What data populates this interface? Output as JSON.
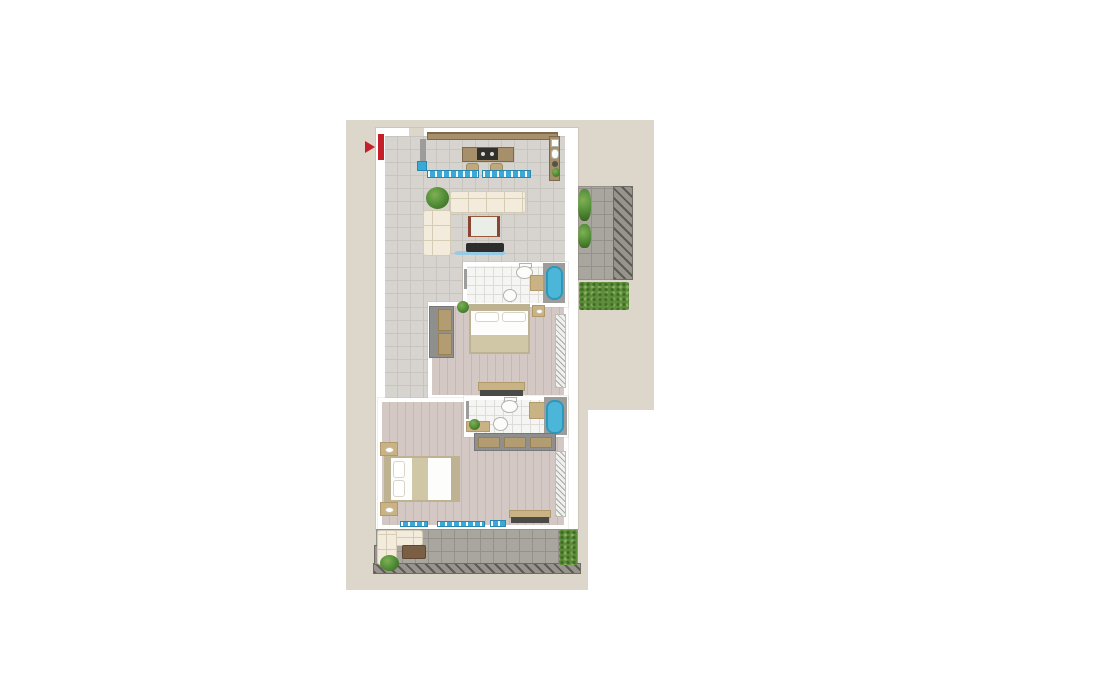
{
  "meta": {
    "type": "floor-plan",
    "description": "Top-down rendered apartment floor plan with no text labels: open living room with kitchen, two bathrooms, two bedrooms, upper-right balcony and lower terrace, red entrance door marker at upper left"
  },
  "palette": {
    "backdrop": "#ddd7cb",
    "wall": "#ffffff",
    "tile-floor": "#d7d4cf",
    "tile-line": "#c8c4be",
    "wood-floor": "#d4c8c4",
    "wood-line": "#c6b8b4",
    "bath-floor": "#f5f5f3",
    "bath-line": "#dddcd7",
    "terrace-tile": "#a9a69f",
    "terrace-line": "#94918a",
    "railing-base": "#97948d",
    "railing-dash": "#5c5a52",
    "railing-edge": "#6e6c65",
    "hedge": "#5e8d3c",
    "hedge-dot-dark": "#3f6b26",
    "hedge-dot-light": "#86b35a",
    "plant": "#4e8a34",
    "plant-light": "#7fb054",
    "plant-dark": "#39651f",
    "tub": "#4cb6d8",
    "tub-rim": "#2f98ba",
    "tub-pad": "#9c9c9a",
    "counter": "#a5906b",
    "counter-edge": "#7c6a4b",
    "stool": "#bfa87c",
    "stove": "#32302b",
    "burner": "#d8dadc",
    "sofa": "#f3ecdc",
    "sofa-edge": "#d6ccb5",
    "wardrobe": "#8f8f8d",
    "wardrobe-door": "#b39c72",
    "bed-frame": "#bdb292",
    "blanket": "#cfc7a6",
    "tan": "#c9b283",
    "fixture": "#fcfcfb",
    "fixture-edge": "#b3b3ae",
    "radiator": "#f0f0ee",
    "radiator-line": "#a8a8a4",
    "glass": "#3ba9d8",
    "glass-shelf": "#8fc9e9",
    "door-red": "#c5202a",
    "tv-dark": "#2d2d2d",
    "table-brown": "#7b5f45",
    "desk-top": "#e9eee6",
    "desk-side": "#8a4433",
    "pillar": "#9c9c9c",
    "dark-front": "#4a4a46"
  },
  "rooms": [
    "living-kitchen",
    "bathroom-1",
    "bedroom-1",
    "bathroom-2",
    "master-bedroom",
    "balcony",
    "terrace"
  ],
  "furniture": [
    "kitchen-counter",
    "kitchen-island-stove",
    "bar-stools",
    "glass-counter",
    "sofa",
    "corner-sofa",
    "coffee-desk",
    "tv-console",
    "toilet",
    "sink",
    "bathtub",
    "bath-mat",
    "wardrobe",
    "double-bed",
    "nightstand",
    "radiator",
    "bench",
    "outdoor-corner-sofa",
    "outdoor-table",
    "plants",
    "hedges"
  ],
  "markers": {
    "entrance": "red-door-with-arrow"
  }
}
